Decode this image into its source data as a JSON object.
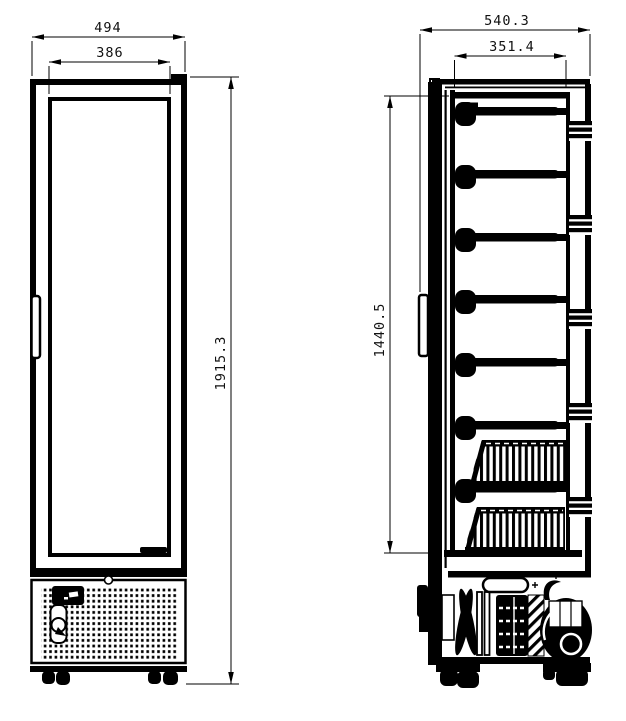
{
  "drawing": {
    "front_view": {
      "overall_width": "494",
      "door_glass_width": "386",
      "overall_height": "1915.3"
    },
    "side_view": {
      "overall_depth": "540.3",
      "interior_depth": "351.4",
      "interior_height": "1440.5",
      "shelf_count": 7,
      "basket_count": 2
    },
    "colors": {
      "line": "#000000",
      "background": "#ffffff"
    }
  }
}
